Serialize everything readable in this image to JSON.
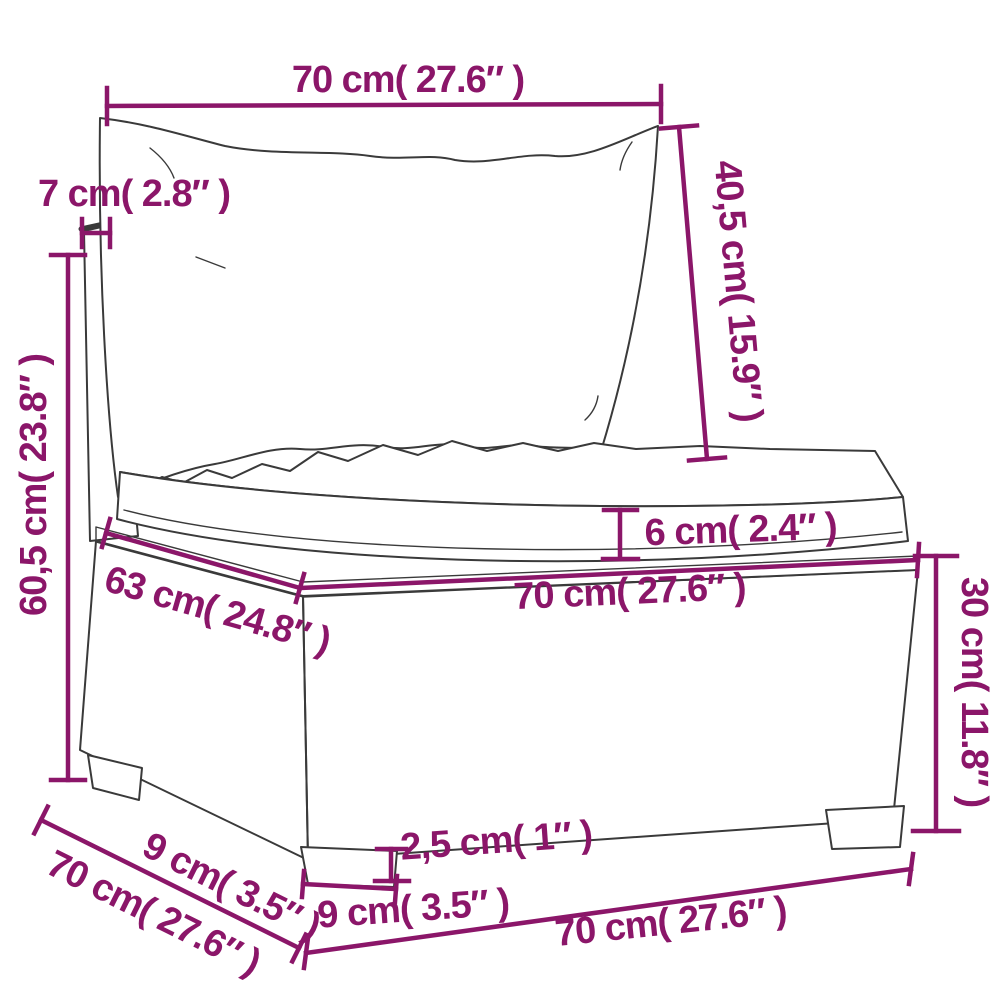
{
  "diagram": {
    "description": "sofa-section-dimension-diagram",
    "accent_color": "#8b1669",
    "line_color": "#3a3a3a",
    "dim": {
      "top_width": "70 cm( 27.6″ )",
      "frame_thickness": "7 cm( 2.8″ )",
      "back_cushion_height": "40,5 cm( 15.9″ )",
      "total_height": "60,5 cm( 23.8″ )",
      "cushion_thickness": "6 cm( 2.4″ )",
      "seat_depth": "63 cm( 24.8″ )",
      "seat_width": "70 cm( 27.6″ )",
      "base_height": "30 cm( 11.8″ )",
      "foot_height": "2,5 cm( 1″ )",
      "foot_width": "9 cm( 3.5″ )",
      "foot_depth": "9 cm( 3.5″ )",
      "side_depth": "70 cm( 27.6″ )",
      "bottom_width": "70 cm( 27.6″ )"
    }
  }
}
